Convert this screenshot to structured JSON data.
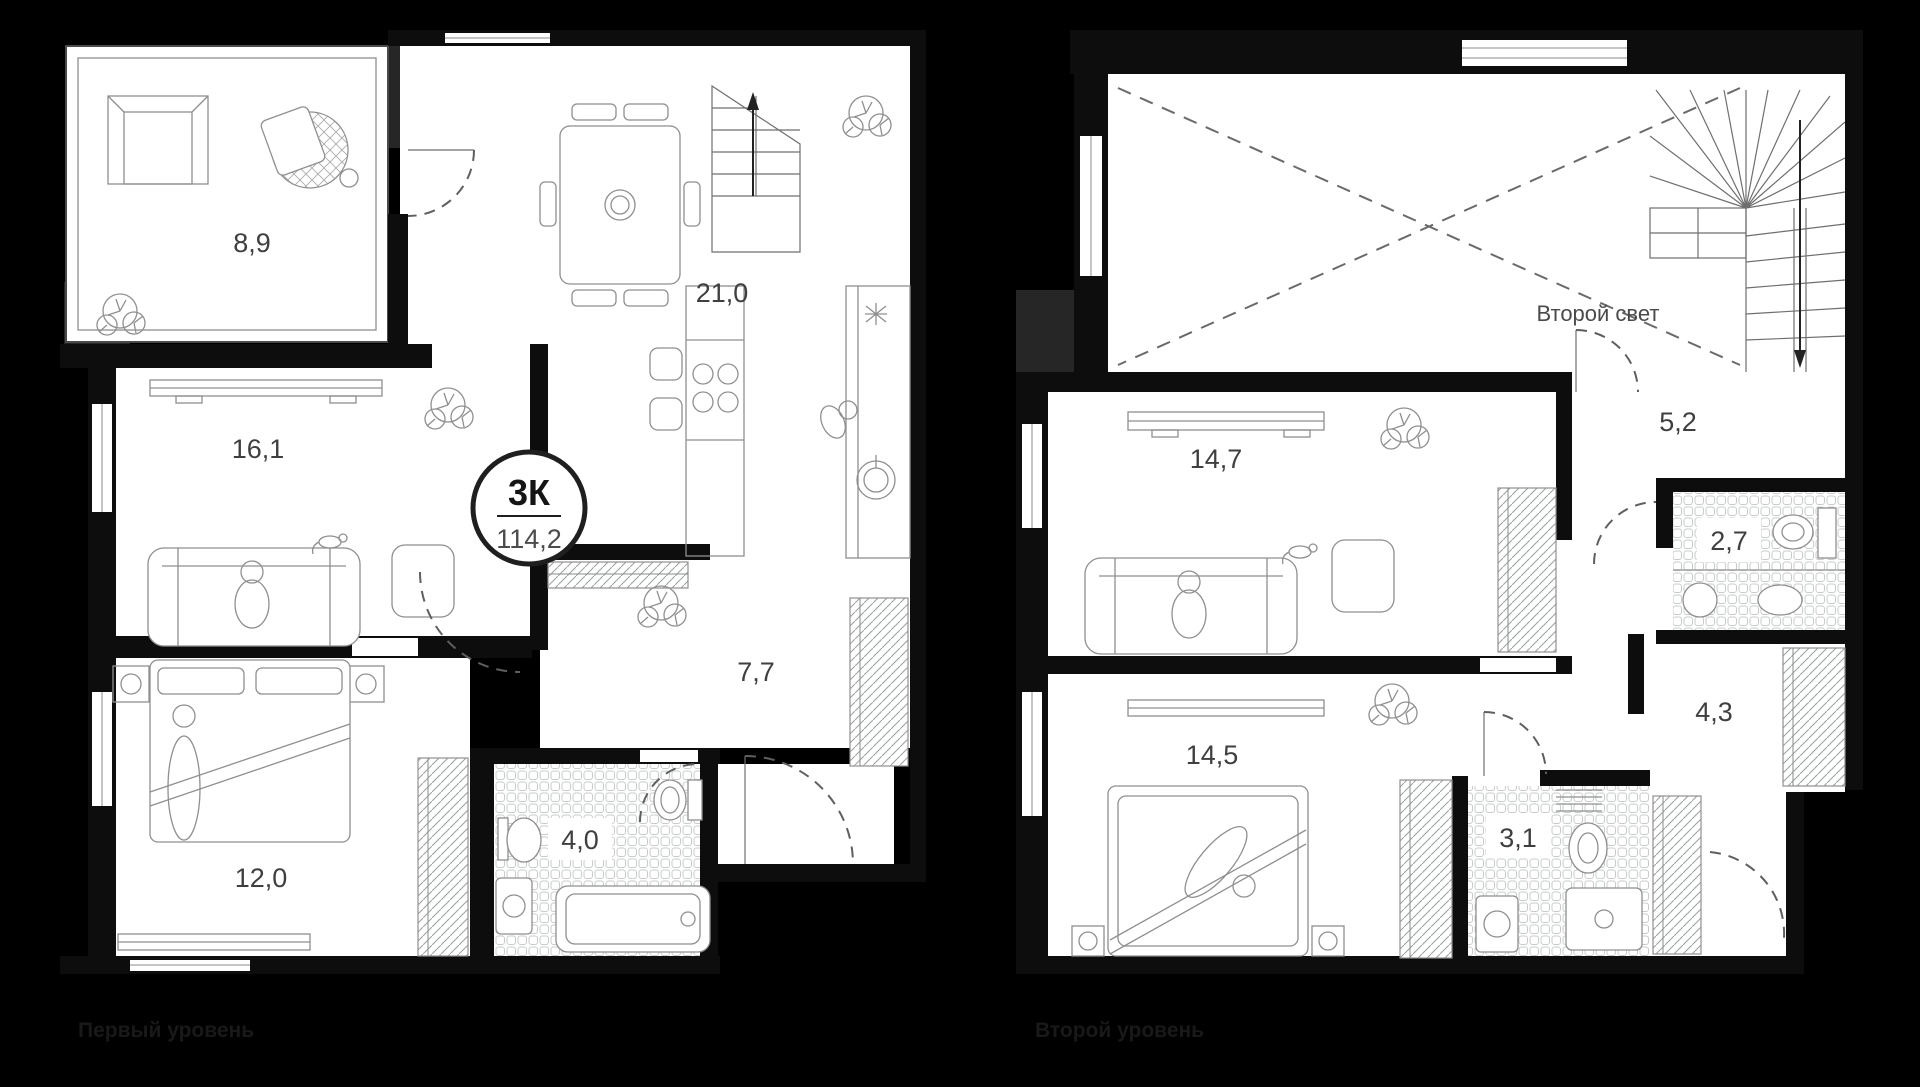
{
  "page": {
    "background_color": "#000000"
  },
  "apartment": {
    "badge_rooms": "3К",
    "badge_area": "114,2"
  },
  "levels": {
    "first": {
      "caption": "Первый уровень",
      "rooms": [
        {
          "name": "loggia",
          "area": "8,9"
        },
        {
          "name": "kitchen-dining",
          "area": "21,0"
        },
        {
          "name": "living-room",
          "area": "16,1"
        },
        {
          "name": "hallway",
          "area": "7,7"
        },
        {
          "name": "bedroom",
          "area": "12,0"
        },
        {
          "name": "bathroom",
          "area": "4,0"
        }
      ]
    },
    "second": {
      "caption": "Второй уровень",
      "void_label": "Второй свет",
      "rooms": [
        {
          "name": "lounge",
          "area": "14,7"
        },
        {
          "name": "stair-hall",
          "area": "5,2"
        },
        {
          "name": "wc",
          "area": "2,7"
        },
        {
          "name": "hallway",
          "area": "4,3"
        },
        {
          "name": "bedroom",
          "area": "14,5"
        },
        {
          "name": "bathroom",
          "area": "3,1"
        }
      ]
    }
  },
  "colors": {
    "background": "#000000",
    "wall": "#0d0d0d",
    "wall_secondary": "#262626",
    "room_fill": "#ffffff",
    "furniture_stroke": "#8f8f8f",
    "area_label": "#3f3f3f",
    "caption": "#1a1a1a",
    "badge_border": "#1f1f1f"
  }
}
